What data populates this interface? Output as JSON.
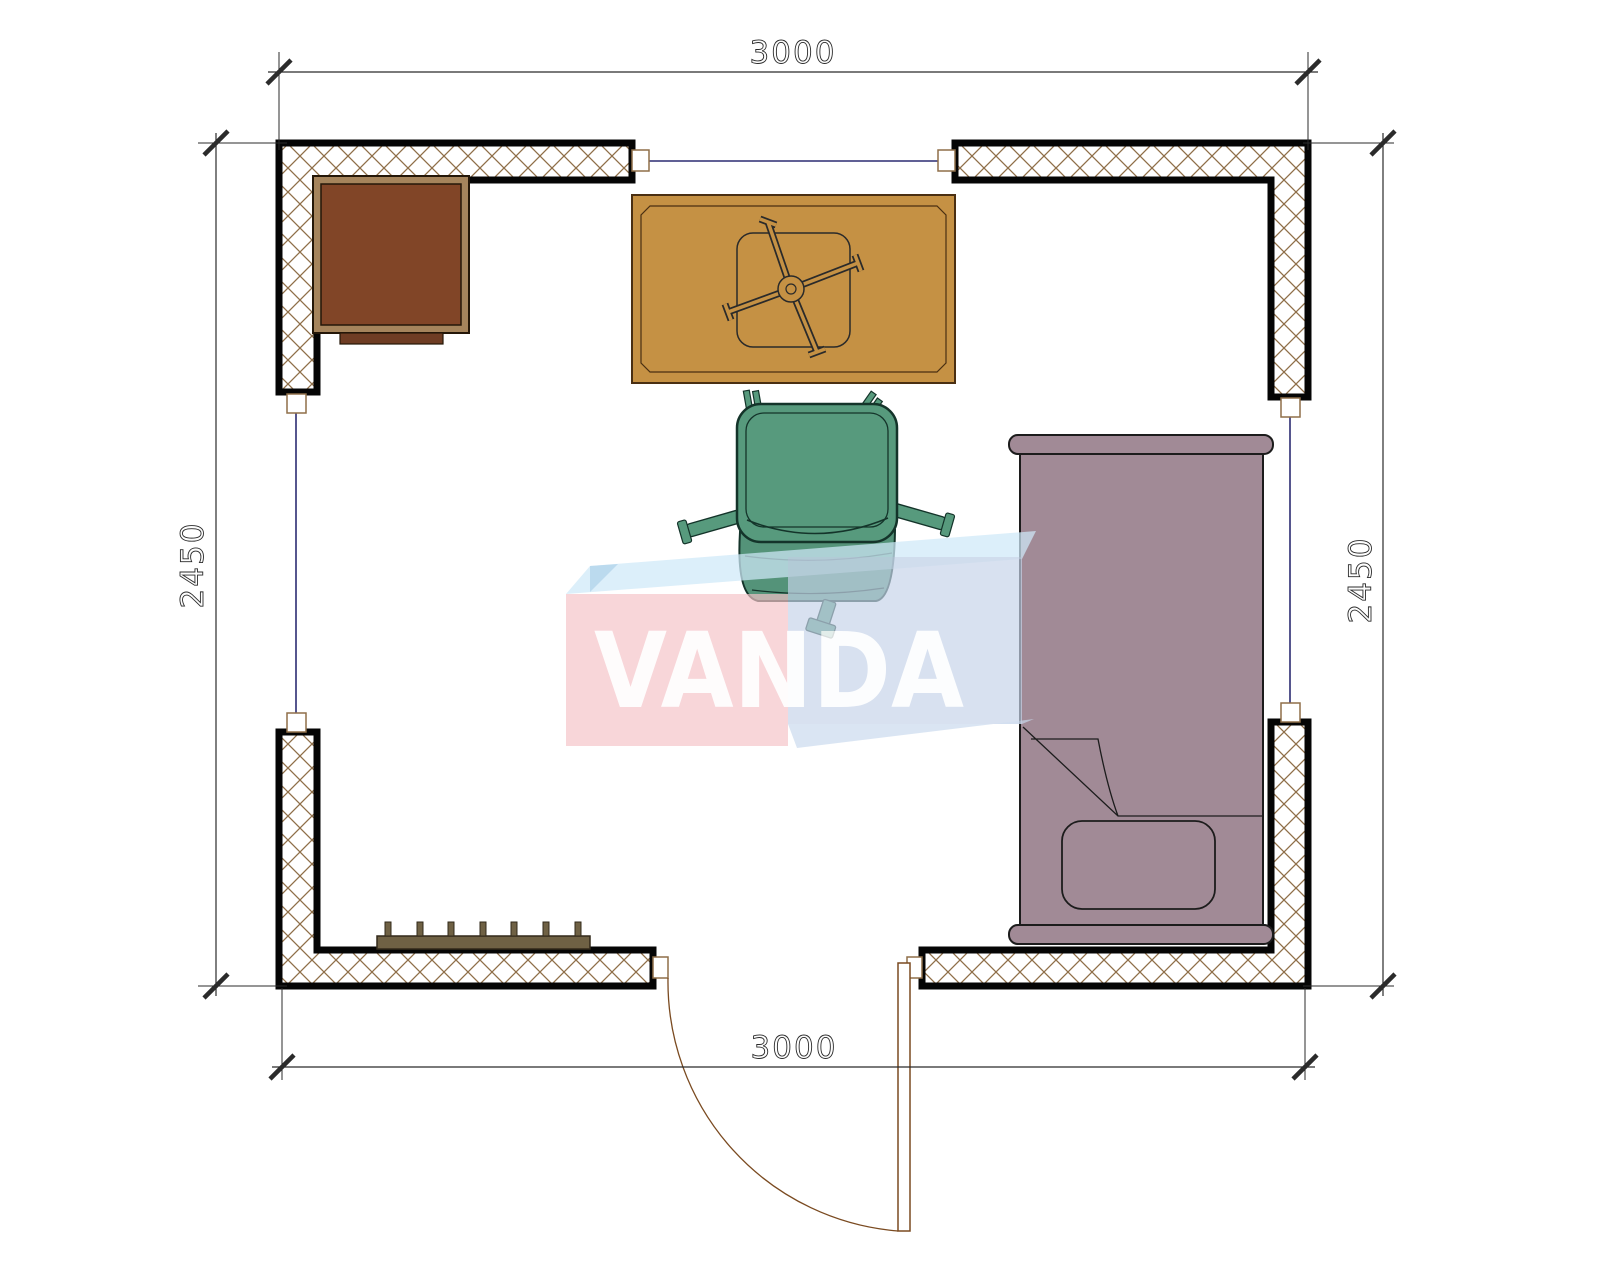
{
  "title": "room-floor-plan",
  "dims": {
    "top": "3000",
    "bottom": "3000",
    "left": "2450",
    "right": "2450"
  },
  "watermark": {
    "text": "VANDA",
    "pink": "#f5c3c8",
    "blue": "#c5d3e8",
    "top_face": "#cfe9f8"
  },
  "room": {
    "width_mm": 3000,
    "depth_mm": 2450
  },
  "objects": [
    {
      "name": "desk",
      "color": "#814527",
      "frame_color": "#a5845c",
      "position": "top-left"
    },
    {
      "name": "table-with-pedestal-base",
      "color": "#c59144",
      "position": "top-center"
    },
    {
      "name": "office-chair",
      "color": "#579a7d",
      "position": "center"
    },
    {
      "name": "single-bed-with-pillow",
      "color": "#a18a96",
      "position": "right"
    },
    {
      "name": "radiator",
      "color": "#6f6144",
      "position": "bottom-left"
    },
    {
      "name": "door-with-swing-arc",
      "color": "#7a4a20",
      "position": "bottom-center"
    },
    {
      "name": "window",
      "color": "#2c2c72",
      "position": "top"
    },
    {
      "name": "window",
      "color": "#2c2c72",
      "position": "left"
    },
    {
      "name": "window",
      "color": "#2c2c72",
      "position": "right"
    }
  ],
  "colors": {
    "wall_hatch": "#8f6f49",
    "wall_outline": "#050505",
    "dimension": "#2b2b2b",
    "background": "#ffffff"
  }
}
